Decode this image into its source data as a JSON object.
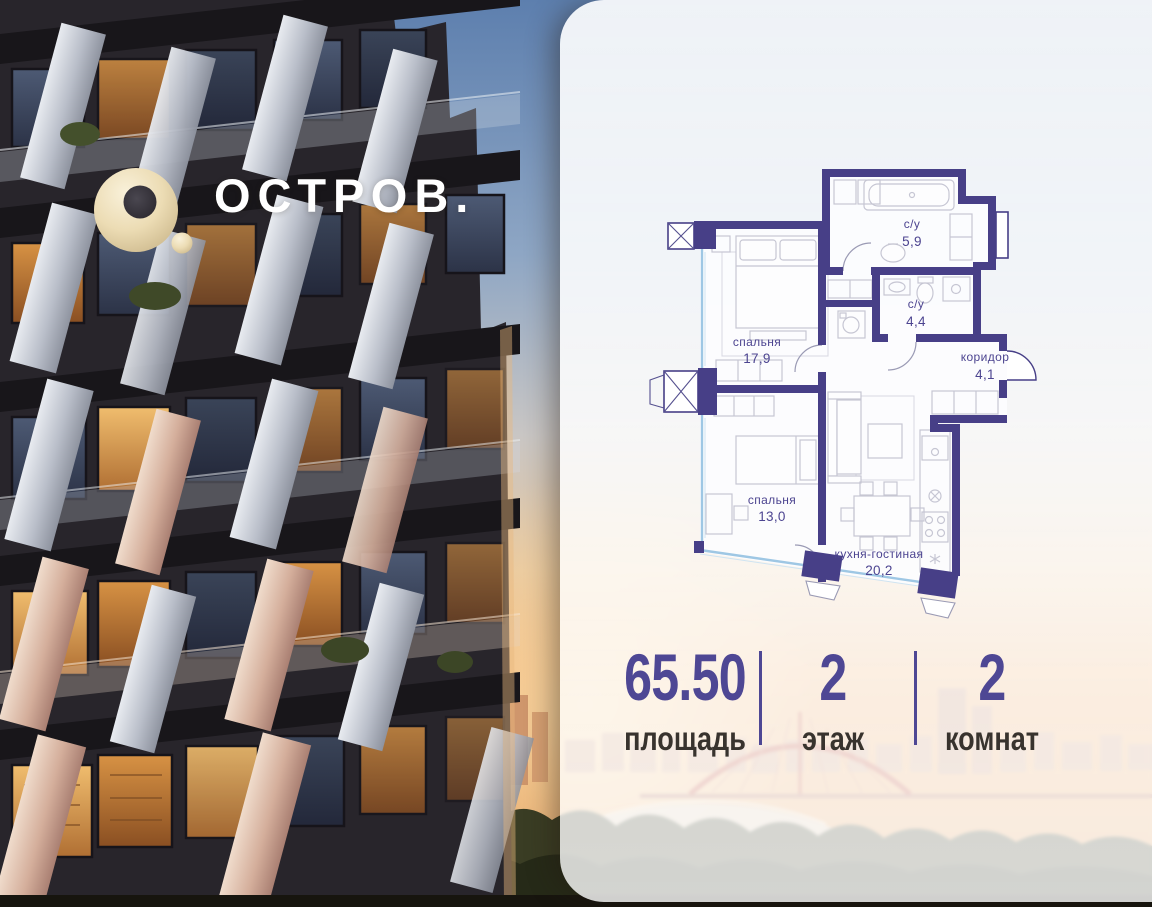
{
  "brand": {
    "name": "ОСТРОВ."
  },
  "floor_plan": {
    "rooms": [
      {
        "id": "bedroom-1",
        "name": "спальня",
        "area": "17,9"
      },
      {
        "id": "bathroom-1",
        "name": "с/у",
        "area": "5,9"
      },
      {
        "id": "bathroom-2",
        "name": "с/у",
        "area": "4,4"
      },
      {
        "id": "corridor",
        "name": "коридор",
        "area": "4,1"
      },
      {
        "id": "bedroom-2",
        "name": "спальня",
        "area": "13,0"
      },
      {
        "id": "kitchen-living",
        "name": "кухня-гостиная",
        "area": "20,2"
      }
    ]
  },
  "stats": [
    {
      "value": "65.50",
      "label": "площадь"
    },
    {
      "value": "2",
      "label": "этаж"
    },
    {
      "value": "2",
      "label": "комнат"
    }
  ],
  "colors": {
    "accent_indigo": "#4e4794",
    "plan_wall": "#473f87",
    "plan_window": "#9ec7e4",
    "stat_label": "#38332e",
    "logo_cream": "#efe2c0",
    "card_white": "#ffffff"
  }
}
